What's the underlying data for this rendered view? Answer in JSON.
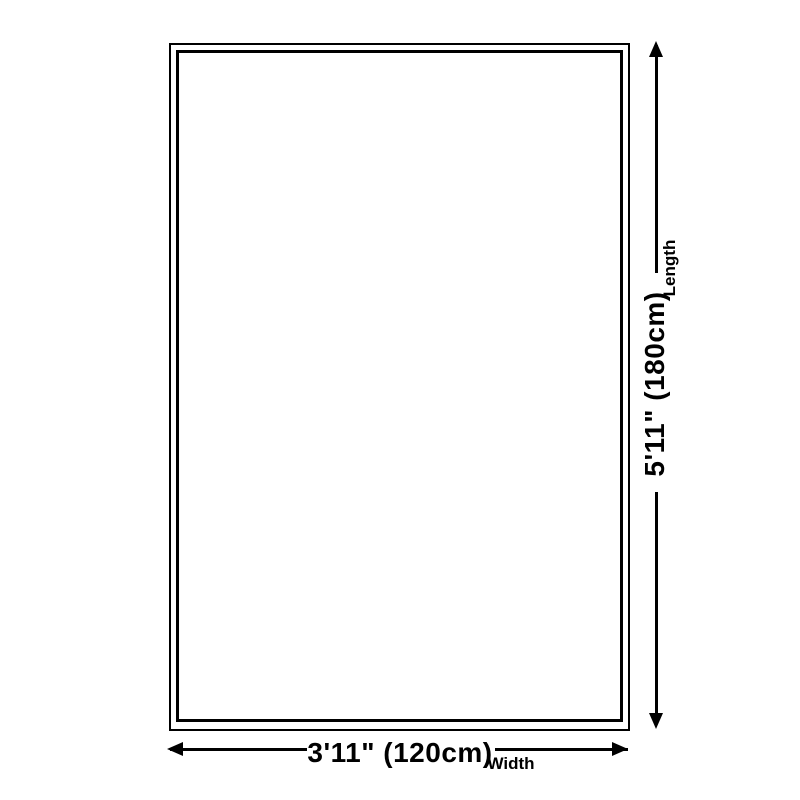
{
  "diagram": {
    "width": {
      "value": "3'11\" (120cm)",
      "label": "Width"
    },
    "length": {
      "value": "5'11\" (180cm)",
      "label": "Length"
    }
  },
  "colors": {
    "line": "#000000",
    "text": "#000000",
    "background": "#ffffff"
  },
  "icons": {
    "arrow_up": "arrow-up-icon",
    "arrow_down": "arrow-down-icon",
    "arrow_left": "arrow-left-icon",
    "arrow_right": "arrow-right-icon"
  }
}
